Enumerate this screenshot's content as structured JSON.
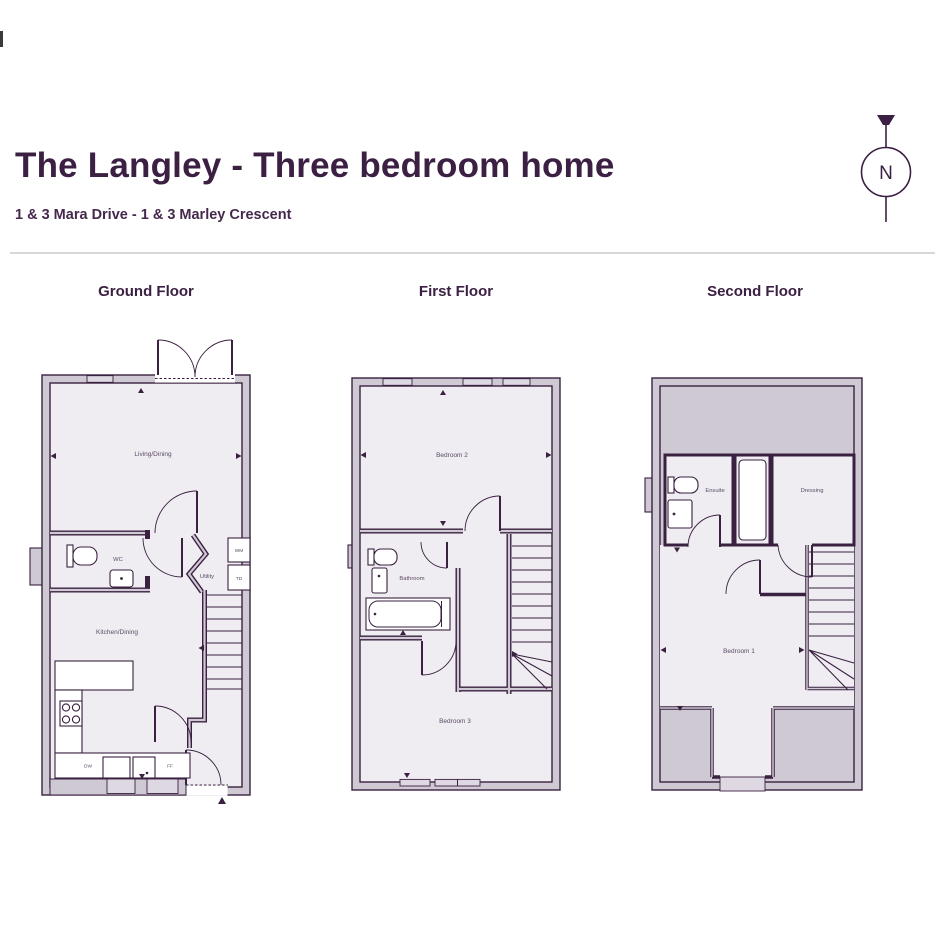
{
  "header": {
    "title": "The Langley - Three bedroom home",
    "subtitle": "1 & 3 Mara Drive - 1 & 3 Marley Crescent"
  },
  "compass": {
    "north": "N"
  },
  "floors": {
    "ground": {
      "title": "Ground Floor",
      "living_dining": "Living/Dining",
      "wc": "WC",
      "utility": "Utility",
      "kitchen_dining": "Kitchen/Dining",
      "washing_machine": "WM",
      "tumble_dryer": "TD",
      "dishwasher": "DW",
      "fridge_freezer": "FF"
    },
    "first": {
      "title": "First Floor",
      "bedroom2": "Bedroom 2",
      "bathroom": "Bathroom",
      "bedroom3": "Bedroom 3"
    },
    "second": {
      "title": "Second Floor",
      "ensuite": "Ensuite",
      "dressing": "Dressing",
      "bedroom1": "Bedroom 1"
    }
  },
  "colors": {
    "accent": "#3a2140",
    "wall": "#cfc9d4",
    "floor": "#efedf2",
    "window": "#ddd8e1",
    "label": "#5b4b64"
  }
}
